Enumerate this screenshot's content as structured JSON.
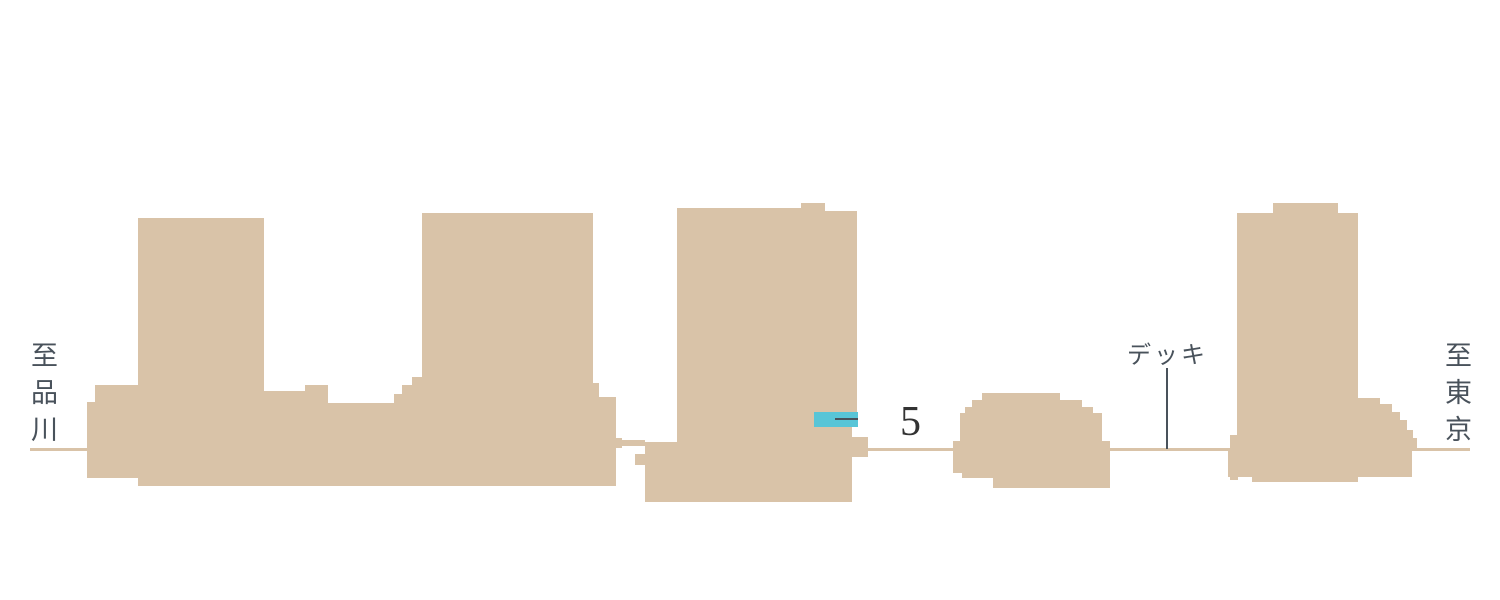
{
  "diagram": {
    "type": "building-elevation-cross-section",
    "labels": {
      "left_direction": "至品川",
      "deck": "デッキ",
      "floor_number": "5",
      "right_direction": "至東京"
    },
    "colors": {
      "background": "#ffffff",
      "building": "#d9c3a8",
      "accent": "#58c5d7",
      "text": "#49525b",
      "number": "#333333"
    }
  }
}
